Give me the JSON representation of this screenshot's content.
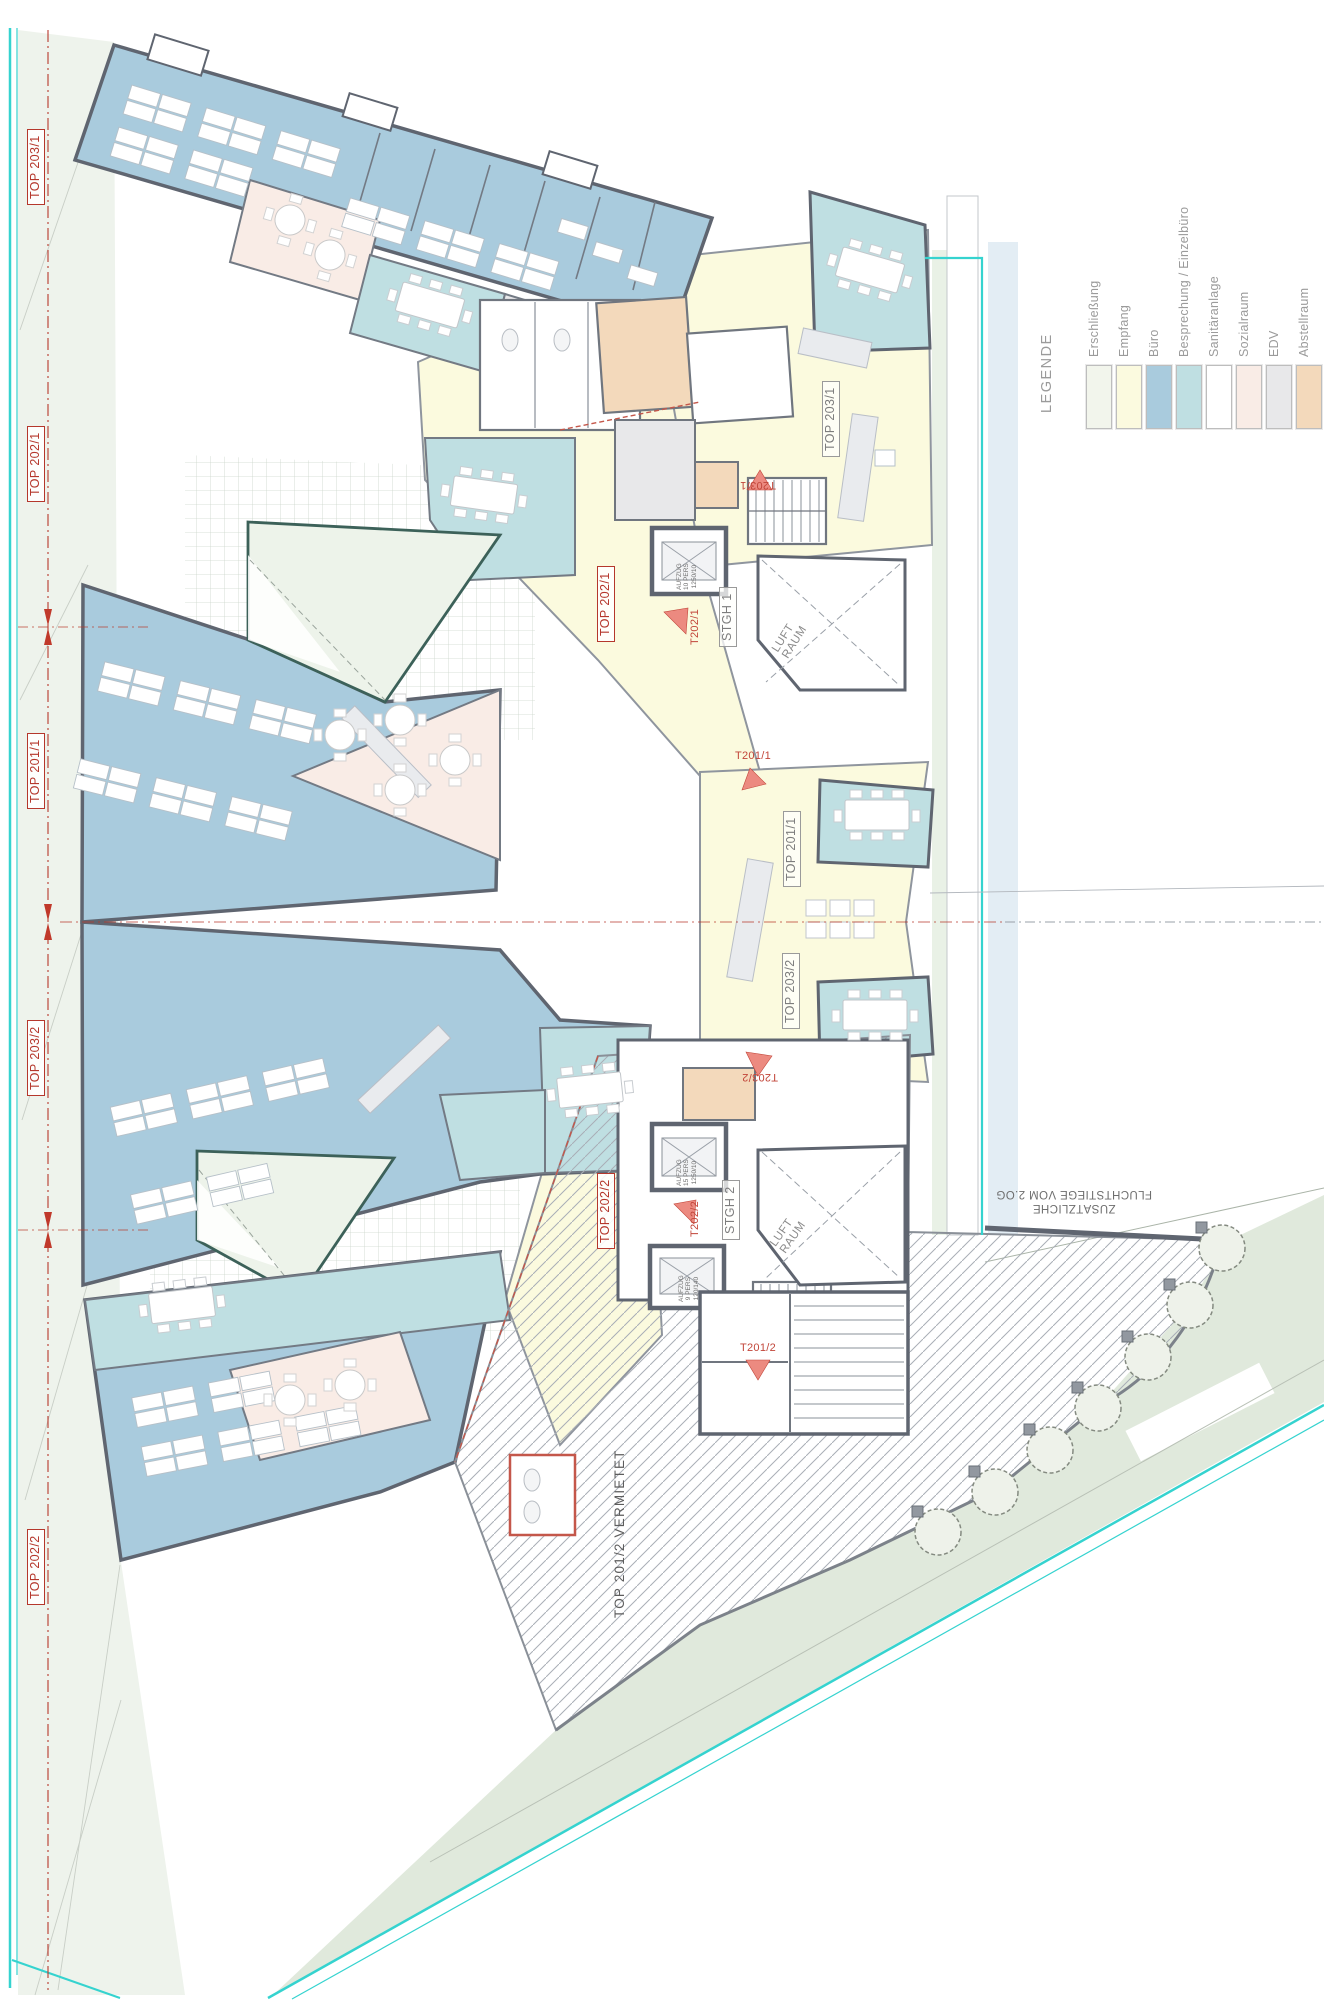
{
  "plan": {
    "axis_labels": [
      {
        "id": "top-203-1",
        "label": "TOP 203/1"
      },
      {
        "id": "top-202-1",
        "label": "TOP 202/1"
      },
      {
        "id": "top-201-1",
        "label": "TOP 201/1"
      },
      {
        "id": "top-203-2",
        "label": "TOP 203/2"
      },
      {
        "id": "top-202-2",
        "label": "TOP 202/2"
      }
    ],
    "units": {
      "u203_1": "TOP 203/1",
      "u201_1": "TOP 201/1",
      "u203_2": "TOP 203/2",
      "u202_1": "TOP 202/1",
      "u202_2": "TOP 202/2",
      "vermietet": "TOP 201/2 VERMIETET"
    },
    "cores": {
      "stgh1": "STGH 1",
      "stgh2": "STGH 2",
      "luft": "LUFT",
      "raum": "RAUM",
      "aufzug": "AUFZUG",
      "a1_pers": "10 PERS",
      "a1_size": "1250/10",
      "a2_pers": "15 PERS",
      "a2_size": "1250/10",
      "a3_pers": "9 PERS",
      "a3_size": "120/140"
    },
    "doors": {
      "t203_1": "T203/1",
      "t202_1": "T202/1",
      "t201_1": "T201/1",
      "t203_2": "T203/2",
      "t202_2": "T202/2",
      "t201_2": "T201/2"
    },
    "note": {
      "l1": "ZUSÄTZLICHE",
      "l2": "FLUCHTSTIEGE VOM 2.OG"
    }
  },
  "legend": {
    "title": "LEGENDE",
    "items": [
      {
        "label": "Erschließung",
        "color": "#f2f5ec"
      },
      {
        "label": "Empfang",
        "color": "#fbfadf"
      },
      {
        "label": "Büro",
        "color": "#a9cbdd"
      },
      {
        "label": "Besprechung / Einzelbüro",
        "color": "#bfdfe2"
      },
      {
        "label": "Sanitäranlage",
        "color": "#ffffff"
      },
      {
        "label": "Sozialraum",
        "color": "#f9ece6"
      },
      {
        "label": "EDV",
        "color": "#e8e8ea"
      },
      {
        "label": "Abstellraum",
        "color": "#f3d9bb"
      }
    ]
  },
  "colors": {
    "wall": "#5f6570",
    "wall_light": "#9aa0a8",
    "site_mint": "#eef3ec",
    "site_green": "#e0e9dc",
    "courtyard_outline": "#3c6159",
    "property_cyan": "#35d3cf",
    "axis_red": "#b8392c",
    "arrow_red": "#ec8a80",
    "hatch_gray": "#a9aeb6",
    "band_blue": "#e3edf4"
  }
}
